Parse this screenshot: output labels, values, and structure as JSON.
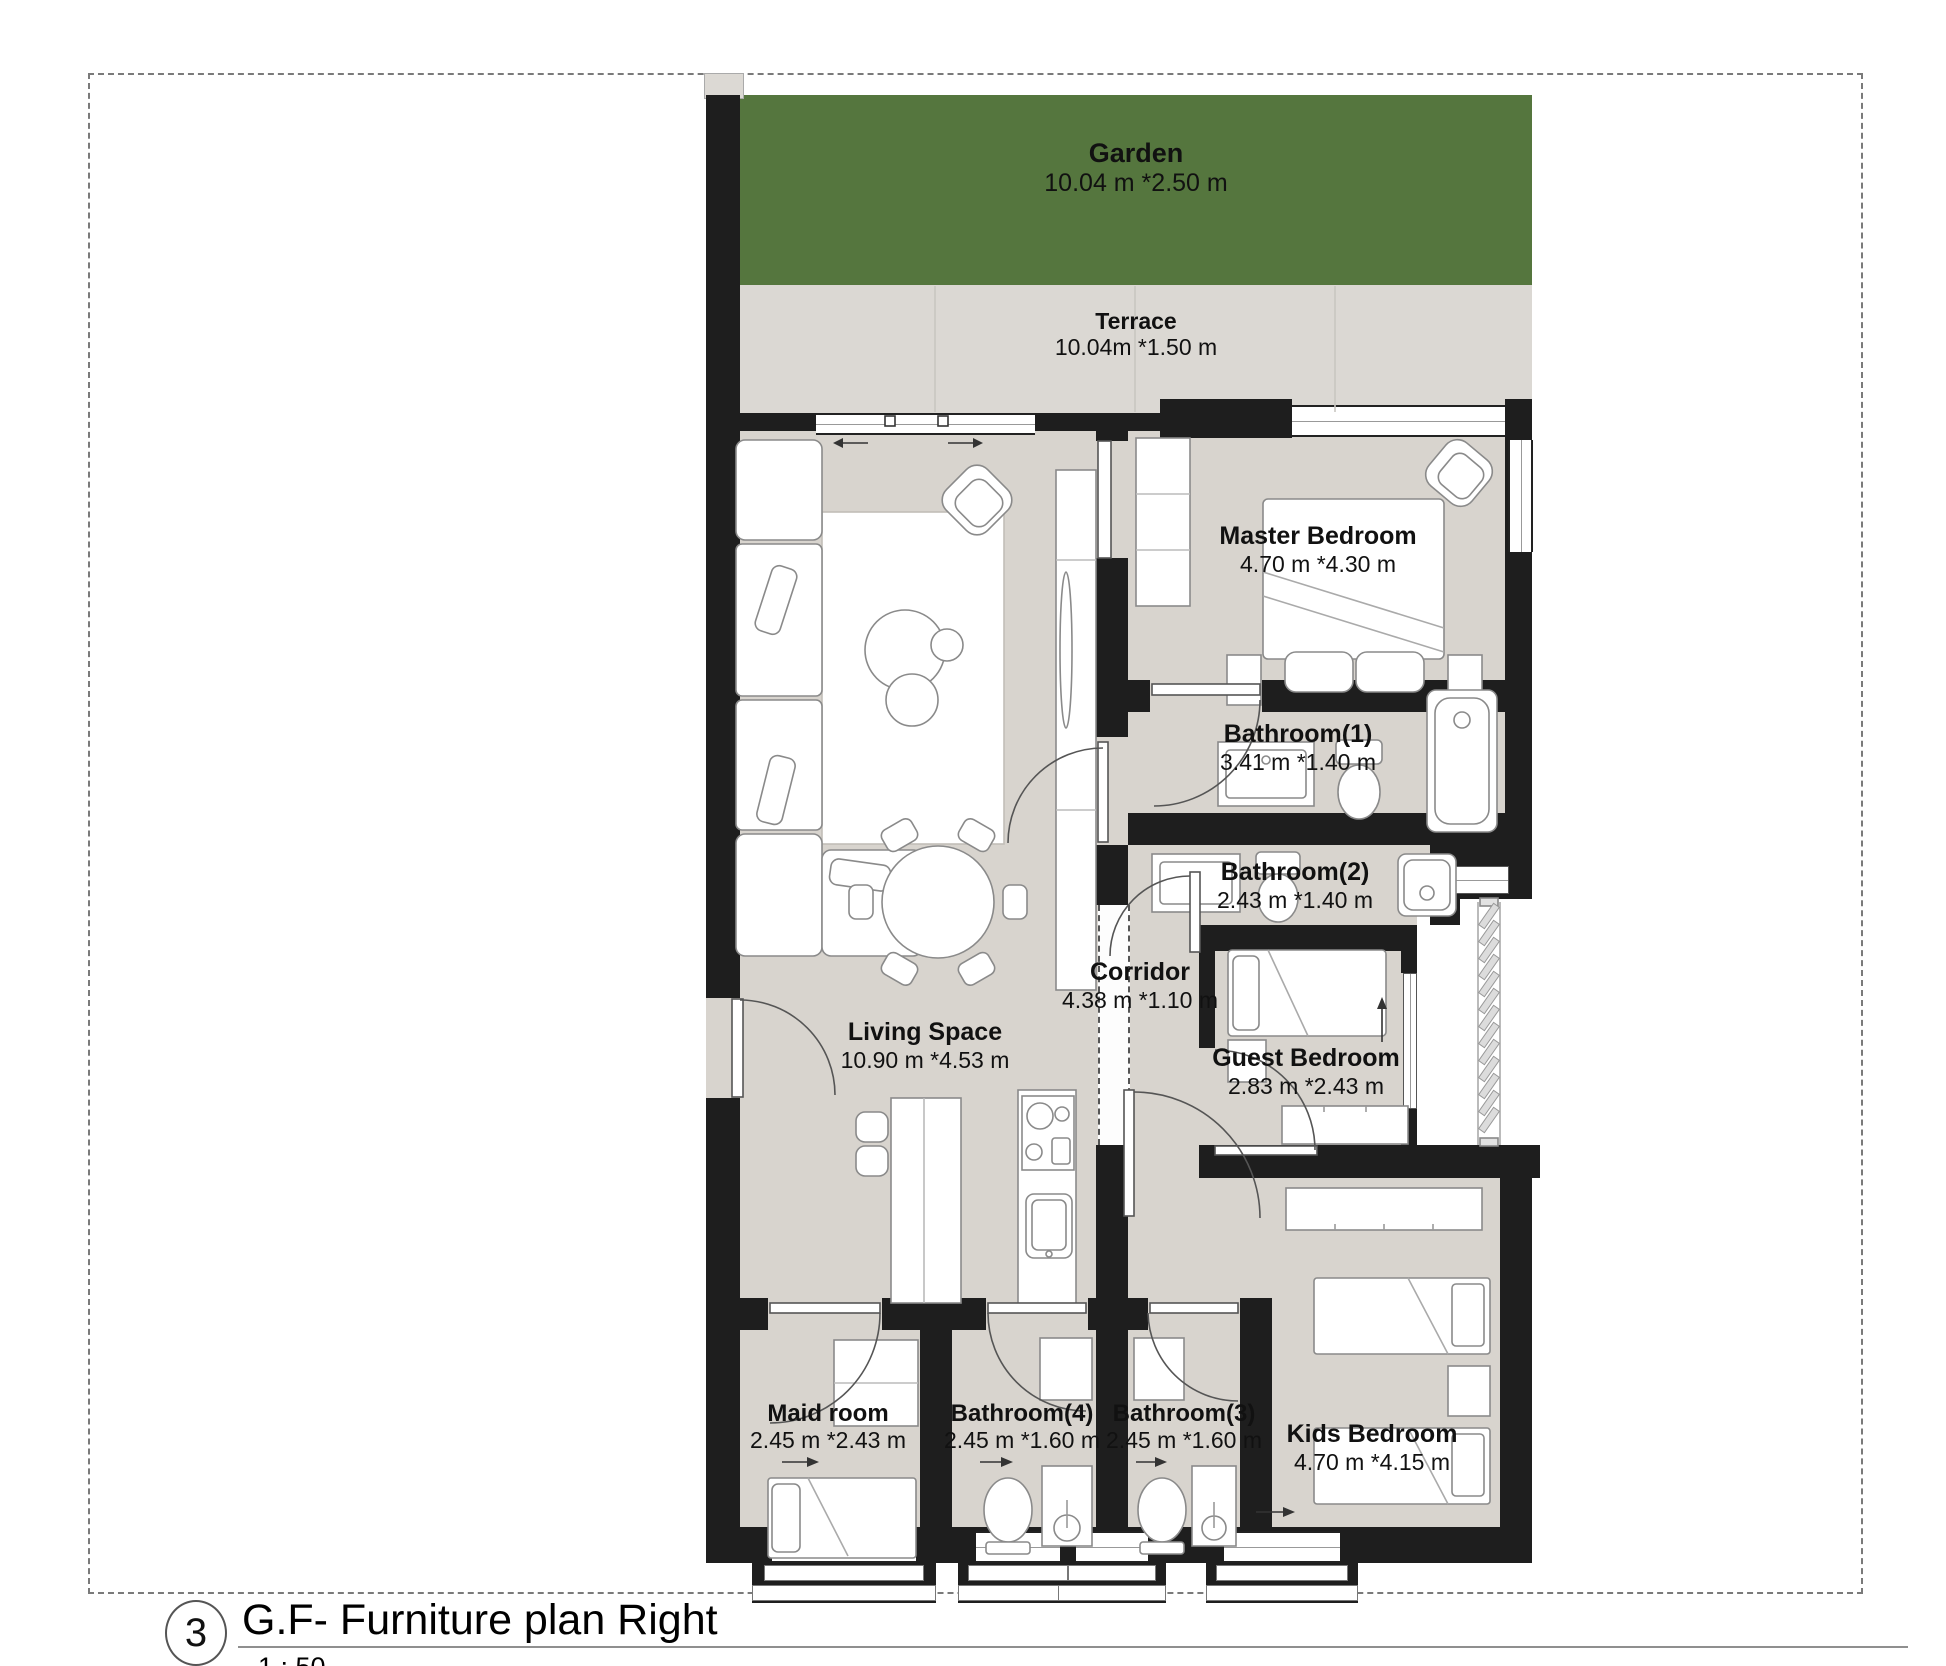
{
  "page": {
    "sheet_number": "3",
    "title": "G.F- Furniture plan Right",
    "scale": "1 : 50"
  },
  "rooms": {
    "garden": {
      "name": "Garden",
      "dims": "10.04 m *2.50 m"
    },
    "terrace": {
      "name": "Terrace",
      "dims": "10.04m *1.50 m"
    },
    "master_bedroom": {
      "name": "Master Bedroom",
      "dims": "4.70 m *4.30 m"
    },
    "bathroom1": {
      "name": "Bathroom(1)",
      "dims": "3.41 m *1.40 m"
    },
    "bathroom2": {
      "name": "Bathroom(2)",
      "dims": "2.43 m *1.40 m"
    },
    "corridor": {
      "name": "Corridor",
      "dims": "4.38 m *1.10 m"
    },
    "living_space": {
      "name": "Living Space",
      "dims": "10.90 m *4.53 m"
    },
    "guest_bedroom": {
      "name": "Guest Bedroom",
      "dims": "2.83 m *2.43 m"
    },
    "maid_room": {
      "name": "Maid room",
      "dims": "2.45 m *2.43 m"
    },
    "bathroom4": {
      "name": "Bathroom(4)",
      "dims": "2.45 m *1.60 m"
    },
    "bathroom3": {
      "name": "Bathroom(3)",
      "dims": "2.45 m *1.60 m"
    },
    "kids_bedroom": {
      "name": "Kids Bedroom",
      "dims": "4.70 m *4.15 m"
    }
  },
  "colors": {
    "wall": "#1e1e1e",
    "floor": "#d8d4ce",
    "garden": "#55763e",
    "terrace": "#dbd8d3"
  }
}
